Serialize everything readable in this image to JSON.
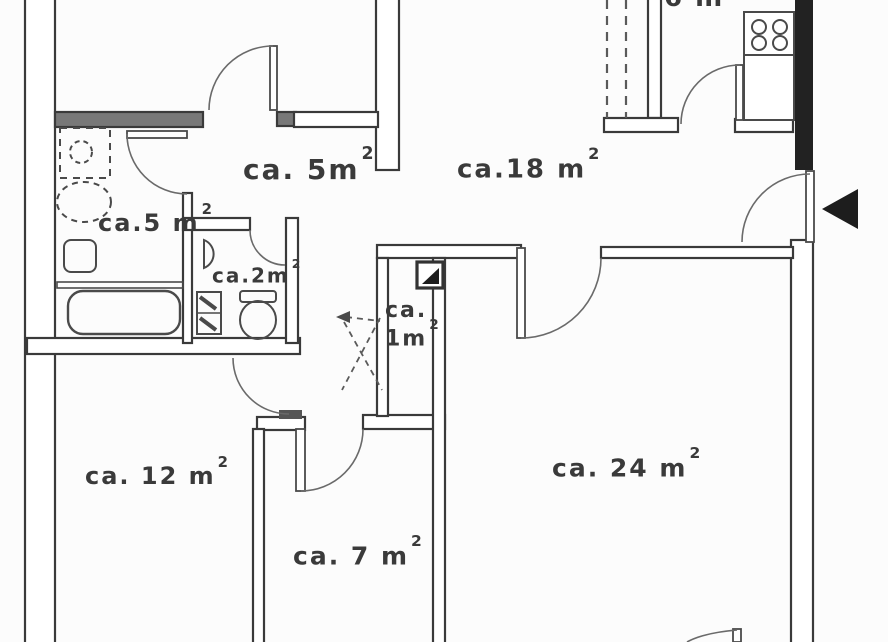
{
  "meta": {
    "type": "apartment-floor-plan",
    "style": "scanned black-and-white architectural drawing"
  },
  "colors": {
    "background": "#fcfcfc",
    "wall_line": "#3a3a3a",
    "wall_dark_fill": "#6e6e6e",
    "wall_black_fill": "#222222",
    "door_arc": "#6a6a6a",
    "text": "#3a3a3a",
    "entrance_arrow": "#1d1d1d"
  },
  "labels": {
    "corridor": {
      "text": "ca. 5m",
      "sup": "2"
    },
    "living": {
      "text": "ca.18 m",
      "sup": "2"
    },
    "bathroom": {
      "text": "ca.5 m",
      "sup": "2"
    },
    "wc": {
      "text": "ca.2m",
      "sup": "2"
    },
    "closet": {
      "line1": "ca.",
      "line2": "1m",
      "sup": "2"
    },
    "room12": {
      "text": "ca. 12 m",
      "sup": "2"
    },
    "room7": {
      "text": "ca. 7 m",
      "sup": "2"
    },
    "room24": {
      "text": "ca. 24 m",
      "sup": "2"
    },
    "kitchen_clipped": {
      "text": "6 m"
    }
  },
  "fixtures": [
    "stove-4-burner-icon",
    "kitchen-counter",
    "shower-icon",
    "washbasin-oval-icon",
    "washbasin-square-icon",
    "bathtub-icon",
    "wc-sink-icon",
    "toilet-icon",
    "duct-shaft-icon",
    "shaft-triangle-marker-icon",
    "vent-cross-marker-icon",
    "entrance-arrow-icon"
  ],
  "entrance": {
    "arrow_direction": "left",
    "location": "right-exterior-wall"
  }
}
